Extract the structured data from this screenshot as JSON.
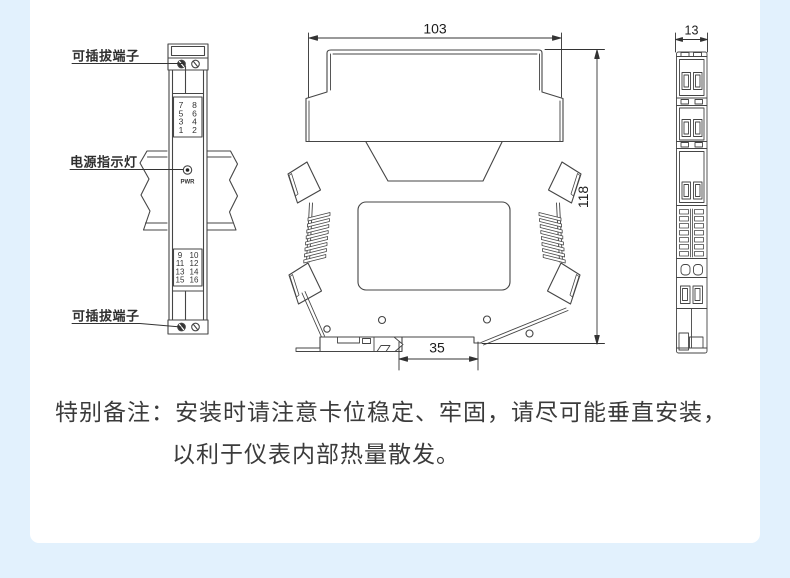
{
  "colors": {
    "page_background": "#e2f1fd",
    "card_background": "#ffffff",
    "line": "#454545",
    "dimension_line": "#333333",
    "note_text": "#3b3b3b"
  },
  "front_view": {
    "label_top_terminal": "可插拔端子",
    "label_power_indicator": "电源指示灯",
    "label_bottom_terminal": "可插拔端子",
    "power_led_label": "PWR",
    "terminals_top": [
      [
        "7",
        "8"
      ],
      [
        "5",
        "6"
      ],
      [
        "3",
        "4"
      ],
      [
        "1",
        "2"
      ]
    ],
    "terminals_bottom": [
      [
        "9",
        "10"
      ],
      [
        "11",
        "12"
      ],
      [
        "13",
        "14"
      ],
      [
        "15",
        "16"
      ]
    ]
  },
  "side_view": {
    "dim_width": "103",
    "dim_height": "118",
    "dim_rail_width": "35"
  },
  "end_view": {
    "dim_width": "13"
  },
  "note": {
    "prefix": "特别备注：",
    "line1": "安装时请注意卡位稳定、牢固，请尽可能垂直安装，",
    "line2": "以利于仪表内部热量散发。"
  }
}
